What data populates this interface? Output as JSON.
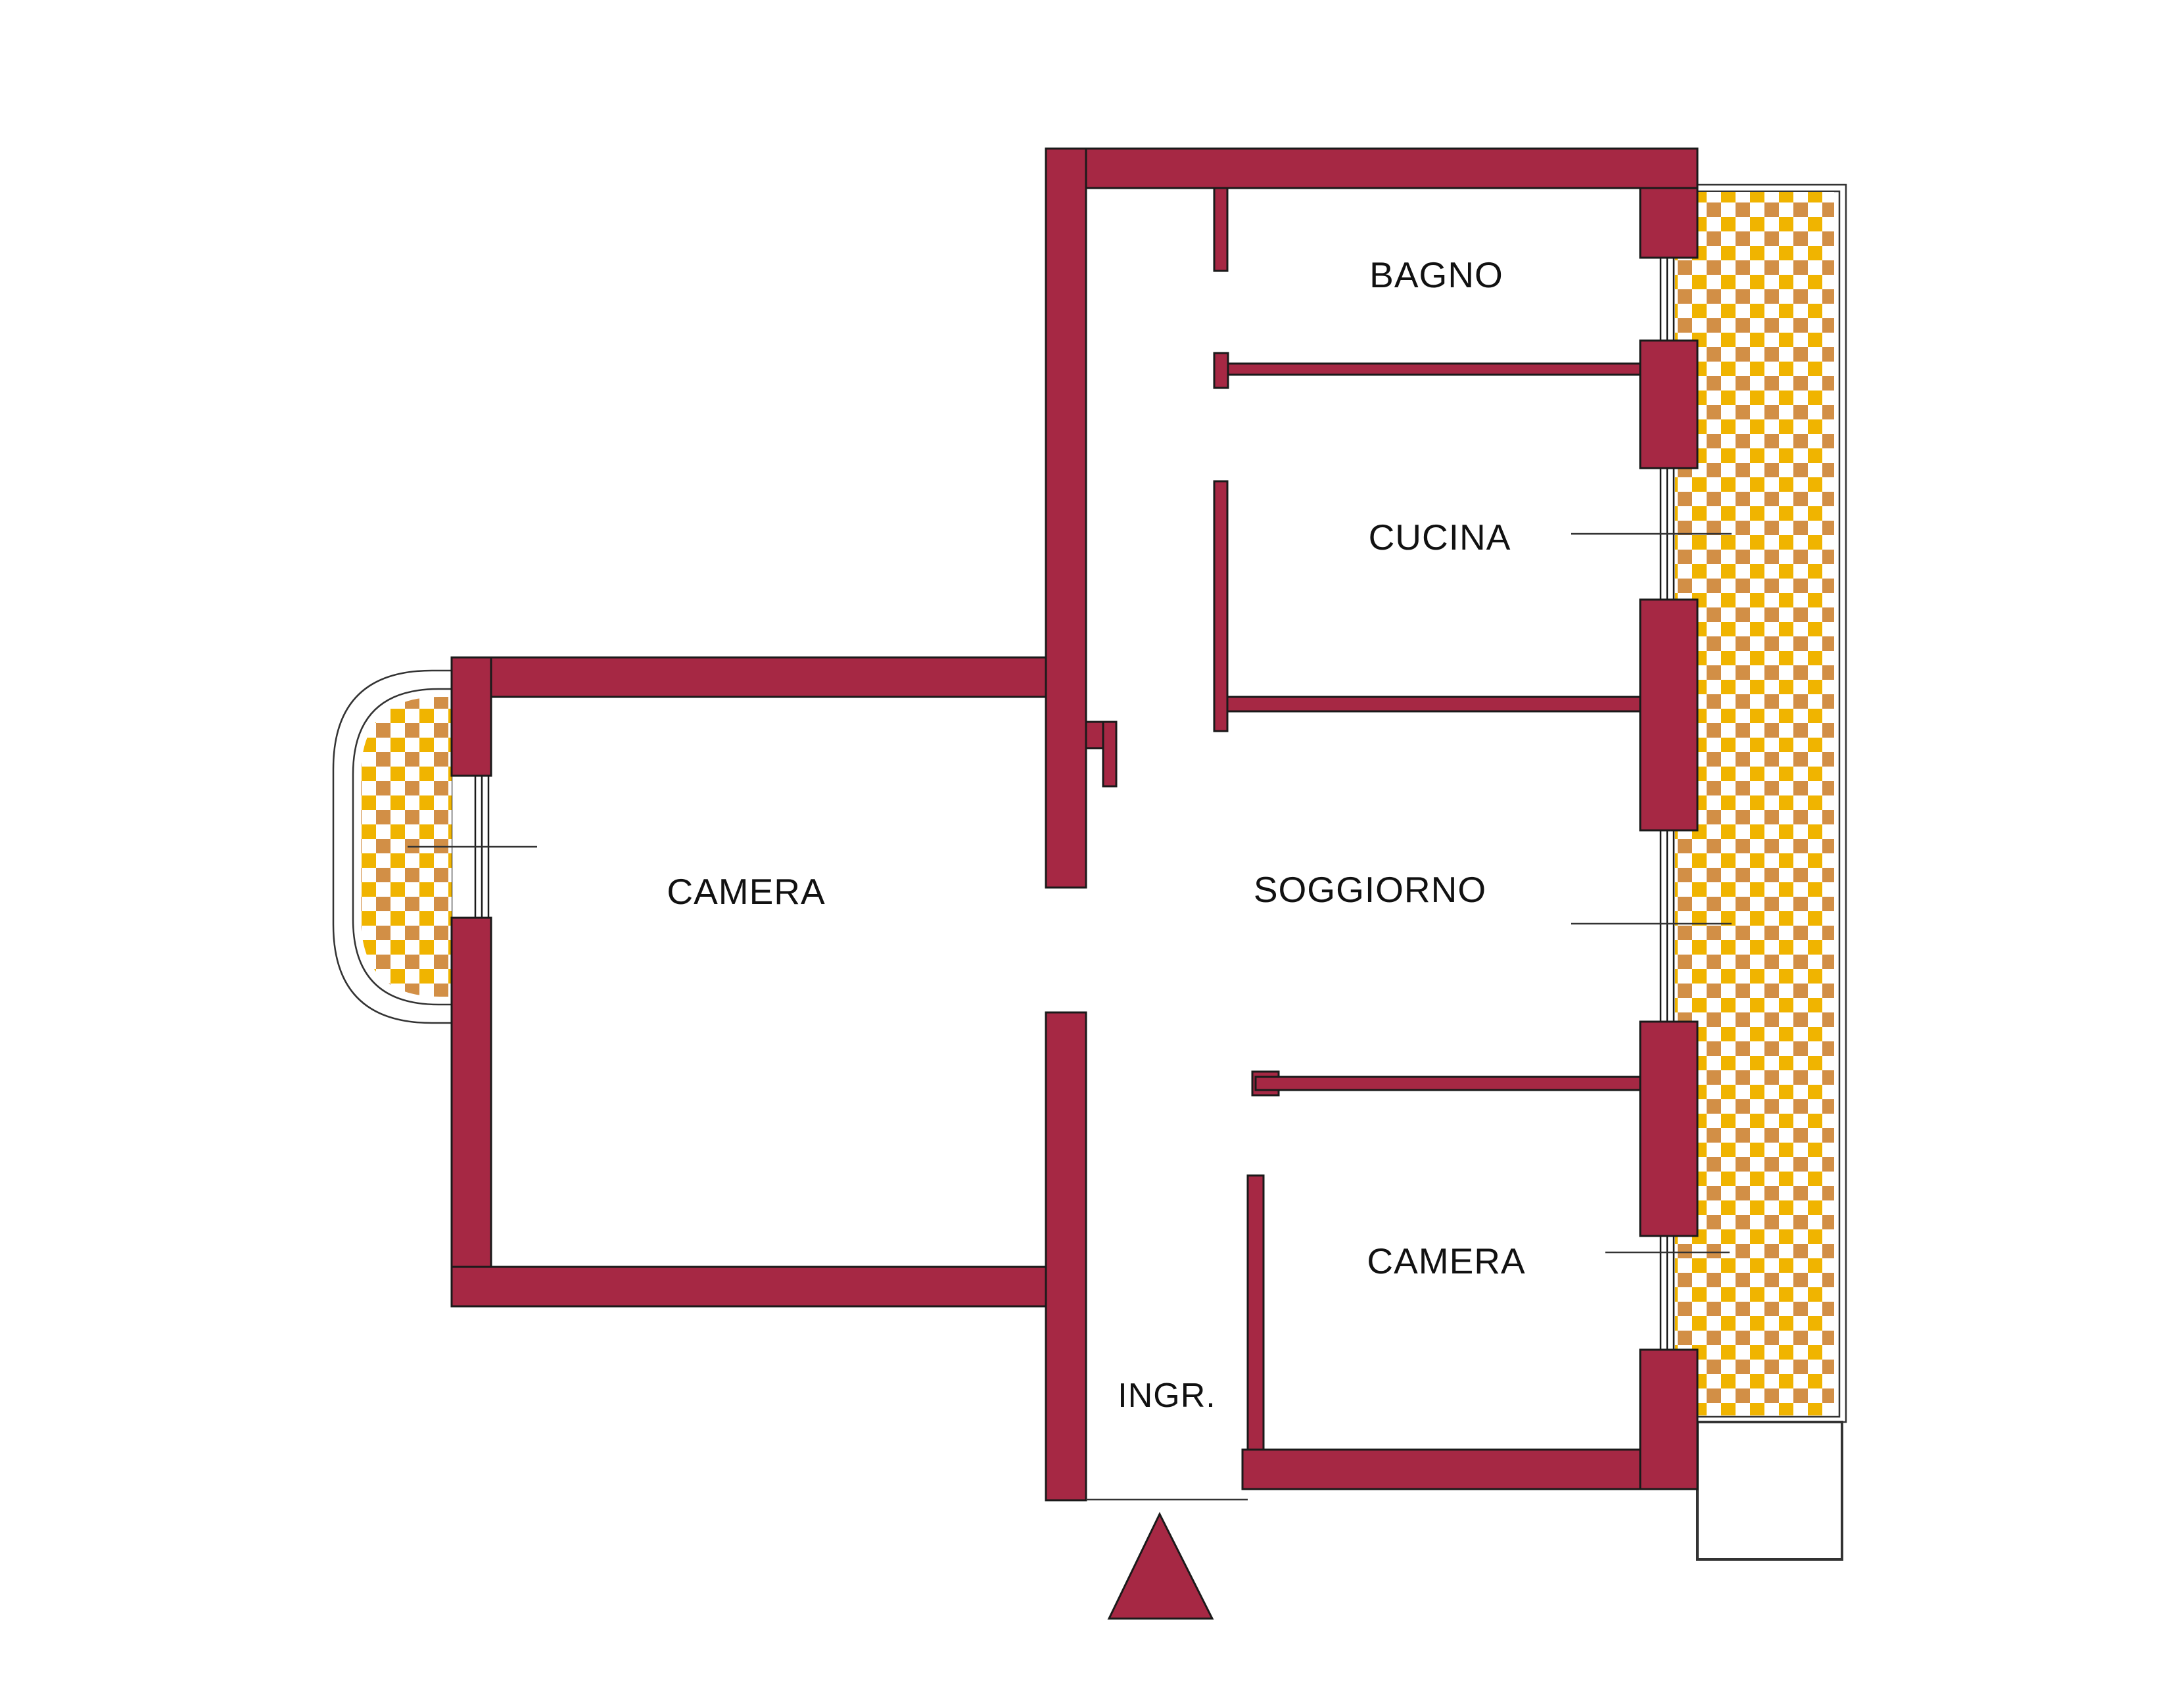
{
  "plan": {
    "type": "apartment-floor-plan",
    "rooms": [
      {
        "id": "bagno",
        "label": "BAGNO"
      },
      {
        "id": "cucina",
        "label": "CUCINA"
      },
      {
        "id": "soggiorno",
        "label": "SOGGIORNO"
      },
      {
        "id": "camera_left",
        "label": "CAMERA"
      },
      {
        "id": "camera_right",
        "label": "CAMERA"
      },
      {
        "id": "ingresso",
        "label": "INGR."
      }
    ],
    "colors": {
      "wall": "#A62844",
      "wall_outline": "#1A1A1A",
      "line": "#333333",
      "checker_gold": "#F0B400",
      "checker_tan": "#D28F46",
      "background": "#FFFFFF"
    }
  }
}
